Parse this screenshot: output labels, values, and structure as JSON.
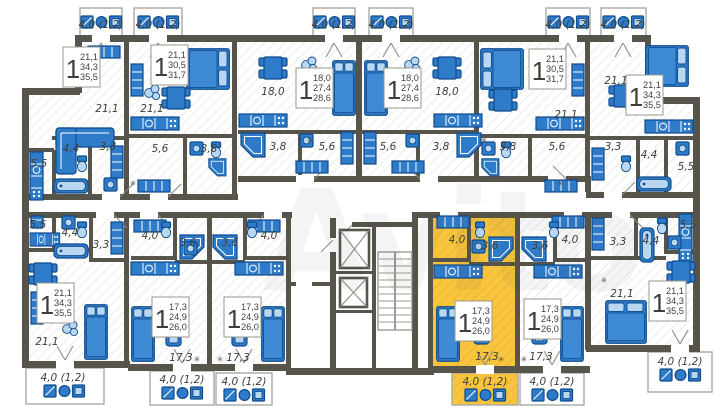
{
  "watermark": "Avito",
  "balcony_label": "4,0 (1,2)",
  "icons": {
    "vent": "✳"
  },
  "colors": {
    "wall": "#57544b",
    "furn": "#2e7bc9",
    "furnD": "#0f4b8c",
    "furnL": "#b9d7f1",
    "hl": "#f8c63e",
    "hlHatch": "#eca42f",
    "hatch": "#e4e4e1",
    "txt": "#3f3f39"
  },
  "apartments": [
    {
      "rooms": "1",
      "living": "21,1",
      "area": "34,3",
      "total": "35,5"
    },
    {
      "rooms": "1",
      "living": "21,1",
      "area": "30,5",
      "total": "31,7"
    },
    {
      "rooms": "1",
      "living": "18,0",
      "area": "27,4",
      "total": "28,6"
    },
    {
      "rooms": "1",
      "living": "18,0",
      "area": "27,4",
      "total": "28,6"
    },
    {
      "rooms": "1",
      "living": "21,1",
      "area": "30,5",
      "total": "31,7"
    },
    {
      "rooms": "1",
      "living": "21,1",
      "area": "34,3",
      "total": "35,5"
    },
    {
      "rooms": "1",
      "living": "21,1",
      "area": "34,3",
      "total": "35,5"
    },
    {
      "rooms": "1",
      "living": "17,3",
      "area": "24,9",
      "total": "26,0"
    },
    {
      "rooms": "1",
      "living": "17,3",
      "area": "24,9",
      "total": "26,0"
    },
    {
      "rooms": "1",
      "living": "17,3",
      "area": "24,9",
      "total": "26,0",
      "highlighted": true
    },
    {
      "rooms": "1",
      "living": "17,3",
      "area": "24,9",
      "total": "26,0"
    },
    {
      "rooms": "1",
      "living": "21,1",
      "area": "34,3",
      "total": "35,5"
    }
  ],
  "room_labels": {
    "a1_living": "21,1",
    "a1_kitchen": "5,5",
    "a1_bath": "4,4",
    "a1_hall": "3,3",
    "a2_living": "21,1",
    "a2_hall": "5,6",
    "a2_bath": "3,8",
    "a3_living": "18,0",
    "a3_bath": "3,8",
    "a3_hall": "5,6",
    "a4_living": "18,0",
    "a4_hall": "5,6",
    "a4_bath": "3,8",
    "a5_living": "21,1",
    "a5_bath": "3,8",
    "a5_hall": "5,6",
    "a6_living": "21,1",
    "a6_hall": "3,3",
    "a6_bath": "4,4",
    "a6_kitchen": "5,5",
    "a7_kitchen": "5,5",
    "a7_bath": "4,4",
    "a7_hall": "3,3",
    "a7_living": "21,1",
    "a8_hall": "4,0",
    "a8_bath": "3,6",
    "a8_living": "17,3",
    "a9_bath": "3,6",
    "a9_hall": "4,0",
    "a9_living": "17,3",
    "a10_hall": "4,0",
    "a10_bath": "3,6",
    "a10_living": "17,3",
    "a11_bath": "3,6",
    "a11_hall": "4,0",
    "a11_living": "17,3",
    "a12_kitchen": "5,5",
    "a12_bath": "4,4",
    "a12_hall": "3,3",
    "a12_living": "21,1"
  }
}
